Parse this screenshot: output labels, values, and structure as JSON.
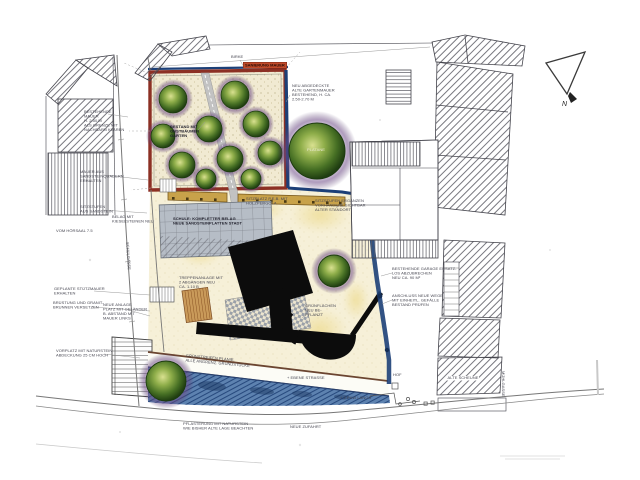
{
  "plan": {
    "north_label": "N",
    "red_banner": "SANIERUNG MAUER",
    "street_names": {
      "west": "SCHULGASSE",
      "east": "MÜHLGASSE"
    },
    "labels": [
      "BESTEHENDE\nMAUER\nH. 2.50 M\nALS GRENZE MIT\nNACHBARN KLÄREN",
      "MAUER AUS\nSANDSTEINQUADERN\nERHALTEN",
      "SITZSTUFEN\nAUS SANDSTEIN",
      "BELAG MIT\nKIESELSTEINEN NEU",
      "VOM HÖRSAAL  7.5",
      "GEPLANTE STÜTZMAUER\nERHALTEN",
      "BRÜSTUNG UND GRANIT-\nBRUNNEN VERSETZEN",
      "VORPLATZ MIT NATURSTEIN\nABDECKUNG 25 CM HOCH",
      "BESTAND MIT\nOBSTBÄUMEN\nGARTEN",
      "NEU ABGEDECKTE\nALTE GARTENMAUER\nBESTEHEND, H. CA.\n2.50-2.70 M",
      "PLATANE",
      "BIRKE",
      "SITZPLATZ P.E.B. MIT\nHOLZPERGOLA",
      "SITZSTUFEN ERGÄNZEN\nVORHANDENE SICHTBAR\nALTER STANDORT",
      "SCHULE: KOMPLETTER BELAG\nNEUE SANDSTEINPLATTEN STADT",
      "TREPPENANLAGE MIT\n2 ABGÄNGEN NEU\nCA. 1.10 B",
      "NEUE ANLAGE\nPLATZ MIT GELÄNDER\nB. ABSTAND MIT\nMAUER LINKS",
      "GRÜNSTREIFEN PLANIE,\nALLE ANGRENZ. GRUNDSTÜCKE",
      "GRÜNFLÄCHEN\nNEU BE-\nPFLANZT",
      "+ EBENE STRASSE",
      "PFLASTERUNG MIT NATURSTEIN\nWIE BISHER ALTE LAGE BEACHTEN",
      "NEUE ZUFAHRT",
      "+ 2 PKW LÄNGS",
      "HOF",
      "ALTE SCHEUNE",
      "BESTEHENDE GARAGE ERSATZ-\nLOS ABZUBRECHEN\nNEU CA. 90 M²",
      "ANSCHLUSS NEUE WEGE\nMIT EINHEITL. GEFÄLLE\nBESTAND PRÜFEN"
    ],
    "colors": {
      "garden_wall_red": "#8c3024",
      "site_boundary_blue": "#1c3f77",
      "tree_green": "#3f6b22",
      "tree_halo_purple": "#6d4a86",
      "embankment_blue": "#5d82b0",
      "pergola_tan": "#c8a24a",
      "plaza_grey": "#b6bdc6",
      "ground_cream": "#f6f0d8",
      "building_black": "#0c0c0c",
      "banner_red": "#c04a2a"
    }
  }
}
